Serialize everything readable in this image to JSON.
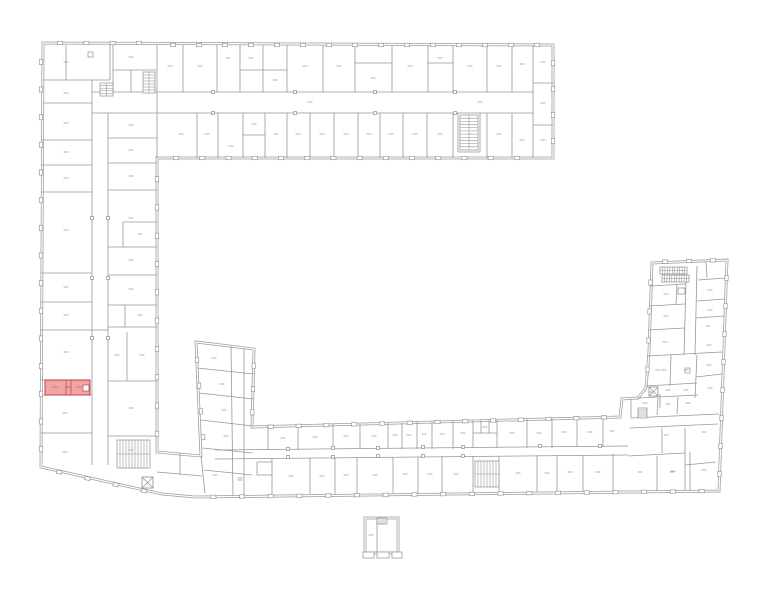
{
  "canvas": {
    "width": 772,
    "height": 600
  },
  "colors": {
    "background": "#ffffff",
    "outer_wall": "#9c9c9c",
    "inner_wall": "#979797",
    "window_stroke": "#9a9a9a",
    "stair_stroke": "#8f8f8f",
    "column_stroke": "#8f8f8f",
    "label_dash": "#ababab",
    "highlight_fill": "#f2a3a3",
    "highlight_stroke": "#c05050",
    "highlight_dash": "#c46b6b"
  },
  "outlines": [
    "M43,43 L553,45 L553,158 L157,158 L157,452 L201,456 L196,342 L254,349 L252,427 L620,417 L622,399 L638,398 L646,388 L649,352 L652,263 L727,260 L719,491 L195,497 L162,494 L41,467 Z",
    "M365,518 H398 V553 H365 Z"
  ],
  "walls": [
    "M66,45 V80",
    "M43,80 H110",
    "M110,45 V80",
    "M43,103 H92",
    "M92,80 V113",
    "M113,45 V92",
    "M113,70 H157",
    "M131,70 V92",
    "M157,45 V158",
    "M41,140 H92",
    "M41,165 H92",
    "M41,192 H92",
    "M41,273 H92",
    "M41,302 H92",
    "M41,330 H92",
    "M41,380 H45",
    "M41,395 H92",
    "M41,433 H92",
    "M92,113 V465",
    "M108,113 V465",
    "M92,330 H108",
    "M108,138 H157",
    "M108,163 H157",
    "M108,190 H157",
    "M123,222 H157",
    "M123,222 V247",
    "M108,247 H157",
    "M108,275 H157",
    "M108,305 H157",
    "M125,305 V327",
    "M108,327 H157",
    "M127,332 V381",
    "M108,381 H157",
    "M108,436 H157",
    "M92,92 H533",
    "M92,113 H533",
    "M533,45 V158",
    "M533,83 H553",
    "M533,125 H553",
    "M183,45 V92",
    "M217,45 V92",
    "M240,45 V92",
    "M263,45 V92",
    "M287,45 V92",
    "M323,45 V92",
    "M355,45 V92",
    "M392,45 V92",
    "M428,45 V92",
    "M453,45 V92",
    "M487,45 V92",
    "M512,45 V92",
    "M240,70 H287",
    "M355,63 H392",
    "M427,63 H453",
    "M197,113 V158",
    "M218,113 V158",
    "M243,113 V158",
    "M265,113 V158",
    "M287,113 V158",
    "M310,113 V158",
    "M334,113 V158",
    "M358,113 V158",
    "M380,113 V158",
    "M403,113 V158",
    "M427,113 V158",
    "M453,113 V158",
    "M487,113 V158",
    "M512,113 V158",
    "M243,135 H265",
    "M458,113 V152",
    "M480,113 V152",
    "M458,152 H480",
    "M157,472 L202,476",
    "M180,453 V475",
    "M201,456 L205,493",
    "M197.5,368 L253.7,374",
    "M199,393 L253.3,399",
    "M200.7,420 L253,426",
    "M202.3,448 L252.6,453",
    "M203.7,470 L252.3,475",
    "M231,346 L233,495",
    "M244,348 L244,496",
    "M215,450 L628,446",
    "M215,459 L628,455",
    "M268,426 V450",
    "M298,425 V450",
    "M333,424 V449",
    "M360,424 V449",
    "M388,423 V449",
    "M402,423 V449",
    "M417,422 V449",
    "M432,422 V449",
    "M453,421 V449",
    "M473,420 V448",
    "M497,420 V448",
    "M527,419 V448",
    "M552,419 V448",
    "M577,418 V447",
    "M603,418 V447",
    "M473,433 H497",
    "M481,420 V433",
    "M489,420 V433",
    "M272,459 V495",
    "M310,458 V494",
    "M335,458 V494",
    "M357,457 V494",
    "M393,457 V493",
    "M418,457 V493",
    "M442,456 V493",
    "M473,456 V492",
    "M499,456 V492",
    "M537,455 V492",
    "M557,455 V492",
    "M583,455 V491",
    "M613,454 V491",
    "M257,462 H272",
    "M257,462 V475",
    "M257,475 H272",
    "M631,399 V417",
    "M660,394 V408",
    "M630,418 L719,414",
    "M630,428 L718,424",
    "M662,428 V453",
    "M685,428 V490",
    "M628,456 L685,453",
    "M657,456 V491",
    "M690,452 V491",
    "M685,465 L716,462",
    "M686,282 L684,355",
    "M697,266 L695,355",
    "M650,286 L686,284",
    "M649,306 L685,304",
    "M648,330 L685,328",
    "M647,356 L722,352",
    "M677,285 L676,305",
    "M698,280 L726,278",
    "M697,301 L725,299",
    "M696,318 L724,316",
    "M671,355 L670,386",
    "M646,386 L697,383",
    "M696,377 L722,374",
    "M697,355 L695,398",
    "M638,398 L698,395",
    "M658,398 L657,415",
    "M678,397 L677,414",
    "M706,262 L707,278",
    "M377,518 V553"
  ],
  "window_runs": [
    {
      "x1": 47,
      "y1": 43,
      "x2": 152,
      "y2": 43,
      "n": 4
    },
    {
      "x1": 160,
      "y1": 45,
      "x2": 550,
      "y2": 45,
      "n": 15
    },
    {
      "x1": 553,
      "y1": 50,
      "x2": 553,
      "y2": 154,
      "n": 4
    },
    {
      "x1": 163,
      "y1": 158,
      "x2": 530,
      "y2": 158,
      "n": 14
    },
    {
      "x1": 41,
      "y1": 48,
      "x2": 41,
      "y2": 463,
      "n": 15
    },
    {
      "x1": 45,
      "y1": 469,
      "x2": 158,
      "y2": 494,
      "n": 4
    },
    {
      "x1": 196,
      "y1": 347,
      "x2": 204,
      "y2": 450,
      "n": 4
    },
    {
      "x1": 254,
      "y1": 354,
      "x2": 252,
      "y2": 424,
      "n": 3
    },
    {
      "x1": 257,
      "y1": 427,
      "x2": 618,
      "y2": 417,
      "n": 13
    },
    {
      "x1": 199,
      "y1": 497,
      "x2": 716,
      "y2": 491,
      "n": 18
    },
    {
      "x1": 653,
      "y1": 262,
      "x2": 725,
      "y2": 260,
      "n": 3
    },
    {
      "x1": 727,
      "y1": 264,
      "x2": 719,
      "y2": 488,
      "n": 8
    },
    {
      "x1": 651,
      "y1": 268,
      "x2": 647,
      "y2": 384,
      "n": 4
    },
    {
      "x1": 157,
      "y1": 165,
      "x2": 157,
      "y2": 448,
      "n": 10
    }
  ],
  "stairs": [
    {
      "x": 100,
      "y": 83,
      "w": 13,
      "h": 13,
      "dir": "h",
      "n": 5
    },
    {
      "x": 143,
      "y": 72,
      "w": 12,
      "h": 21,
      "dir": "h",
      "n": 7
    },
    {
      "x": 460,
      "y": 115,
      "w": 18,
      "h": 35,
      "dir": "h",
      "n": 11
    },
    {
      "x": 117,
      "y": 440,
      "w": 33,
      "h": 28,
      "dir": "v",
      "n": 11
    },
    {
      "x": 475,
      "y": 461,
      "w": 24,
      "h": 26,
      "dir": "v",
      "n": 8
    },
    {
      "x": 660,
      "y": 267,
      "w": 27,
      "h": 7,
      "dir": "v",
      "n": 11
    },
    {
      "x": 662,
      "y": 275,
      "w": 27,
      "h": 7,
      "dir": "v",
      "n": 11
    },
    {
      "x": 638,
      "y": 408,
      "w": 9,
      "h": 10,
      "dir": "h",
      "n": 5
    },
    {
      "x": 377,
      "y": 518,
      "w": 10,
      "h": 6,
      "dir": "v",
      "n": 5
    }
  ],
  "elevators": [
    {
      "x": 142,
      "y": 477,
      "w": 11,
      "h": 11
    },
    {
      "x": 649,
      "y": 387,
      "w": 9,
      "h": 9
    }
  ],
  "fixtures": [
    {
      "x": 363,
      "y": 552,
      "w": 11,
      "h": 6
    },
    {
      "x": 377,
      "y": 552,
      "w": 12,
      "h": 6
    },
    {
      "x": 392,
      "y": 552,
      "w": 10,
      "h": 6
    },
    {
      "x": 678,
      "y": 288,
      "w": 7,
      "h": 6
    },
    {
      "x": 88,
      "y": 52,
      "w": 5,
      "h": 5
    },
    {
      "x": 685,
      "y": 368,
      "w": 5,
      "h": 5
    }
  ],
  "corridor_columns": [
    [
      213,
      92
    ],
    [
      295,
      92
    ],
    [
      375,
      92
    ],
    [
      455,
      92
    ],
    [
      213,
      113
    ],
    [
      295,
      113
    ],
    [
      375,
      113
    ],
    [
      455,
      113
    ],
    [
      92,
      218
    ],
    [
      92,
      278
    ],
    [
      92,
      338
    ],
    [
      108,
      218
    ],
    [
      108,
      278
    ],
    [
      108,
      338
    ],
    [
      288,
      449
    ],
    [
      333,
      448
    ],
    [
      378,
      448
    ],
    [
      423,
      447
    ],
    [
      463,
      447
    ],
    [
      288,
      457
    ],
    [
      333,
      457
    ],
    [
      378,
      456
    ],
    [
      423,
      456
    ],
    [
      463,
      456
    ],
    [
      540,
      446
    ],
    [
      600,
      446
    ]
  ],
  "label_dashes": [
    [
      66,
      62
    ],
    [
      66,
      93
    ],
    [
      66,
      123
    ],
    [
      66,
      152
    ],
    [
      66,
      178
    ],
    [
      66,
      230
    ],
    [
      66,
      287
    ],
    [
      66,
      315
    ],
    [
      66,
      352
    ],
    [
      65,
      413
    ],
    [
      65,
      452
    ],
    [
      131,
      57
    ],
    [
      131,
      125
    ],
    [
      131,
      150
    ],
    [
      131,
      176
    ],
    [
      131,
      218
    ],
    [
      140,
      234
    ],
    [
      131,
      260
    ],
    [
      131,
      289
    ],
    [
      140,
      315
    ],
    [
      117,
      355
    ],
    [
      142,
      355
    ],
    [
      131,
      408
    ],
    [
      131,
      450
    ],
    [
      170,
      66
    ],
    [
      200,
      66
    ],
    [
      228,
      58
    ],
    [
      251,
      58
    ],
    [
      275,
      80
    ],
    [
      305,
      66
    ],
    [
      339,
      66
    ],
    [
      373,
      78
    ],
    [
      410,
      66
    ],
    [
      440,
      58
    ],
    [
      470,
      66
    ],
    [
      499,
      66
    ],
    [
      522,
      64
    ],
    [
      543,
      62
    ],
    [
      310,
      102
    ],
    [
      480,
      102
    ],
    [
      181,
      134
    ],
    [
      207,
      134
    ],
    [
      231,
      146
    ],
    [
      254,
      124
    ],
    [
      276,
      134
    ],
    [
      298,
      134
    ],
    [
      322,
      134
    ],
    [
      346,
      134
    ],
    [
      369,
      134
    ],
    [
      391,
      134
    ],
    [
      415,
      134
    ],
    [
      440,
      134
    ],
    [
      470,
      134
    ],
    [
      499,
      134
    ],
    [
      522,
      140
    ],
    [
      543,
      103
    ],
    [
      543,
      140
    ],
    [
      214,
      358
    ],
    [
      222,
      384
    ],
    [
      224,
      410
    ],
    [
      226,
      436
    ],
    [
      215,
      475
    ],
    [
      240,
      480
    ],
    [
      283,
      438
    ],
    [
      315,
      437
    ],
    [
      346,
      436
    ],
    [
      374,
      436
    ],
    [
      395,
      435
    ],
    [
      409,
      435
    ],
    [
      424,
      434
    ],
    [
      442,
      434
    ],
    [
      463,
      433
    ],
    [
      485,
      427
    ],
    [
      512,
      433
    ],
    [
      539,
      433
    ],
    [
      564,
      432
    ],
    [
      590,
      432
    ],
    [
      612,
      431
    ],
    [
      240,
      478
    ],
    [
      291,
      476
    ],
    [
      322,
      476
    ],
    [
      346,
      475
    ],
    [
      375,
      475
    ],
    [
      405,
      474
    ],
    [
      430,
      474
    ],
    [
      456,
      474
    ],
    [
      518,
      473
    ],
    [
      547,
      473
    ],
    [
      570,
      472
    ],
    [
      598,
      472
    ],
    [
      640,
      472
    ],
    [
      673,
      471
    ],
    [
      704,
      470
    ],
    [
      666,
      294
    ],
    [
      710,
      290
    ],
    [
      666,
      316
    ],
    [
      710,
      310
    ],
    [
      665,
      342
    ],
    [
      708,
      326
    ],
    [
      664,
      370
    ],
    [
      709,
      345
    ],
    [
      709,
      365
    ],
    [
      686,
      370
    ],
    [
      658,
      370
    ],
    [
      652,
      392
    ],
    [
      668,
      390
    ],
    [
      686,
      390
    ],
    [
      710,
      388
    ],
    [
      645,
      403
    ],
    [
      668,
      404
    ],
    [
      688,
      403
    ],
    [
      666,
      435
    ],
    [
      704,
      432
    ],
    [
      672,
      472
    ],
    [
      371,
      535
    ]
  ],
  "highlight": {
    "outer": {
      "x": 45,
      "y": 380,
      "w": 45,
      "h": 15
    },
    "inner_lines": [
      "M66,380 V395",
      "M71,380 V395",
      "M66,387 H71"
    ],
    "notch": {
      "x": 83,
      "y": 385,
      "w": 6,
      "h": 6
    },
    "dashes": [
      [
        55,
        387
      ],
      [
        79,
        387
      ]
    ]
  }
}
